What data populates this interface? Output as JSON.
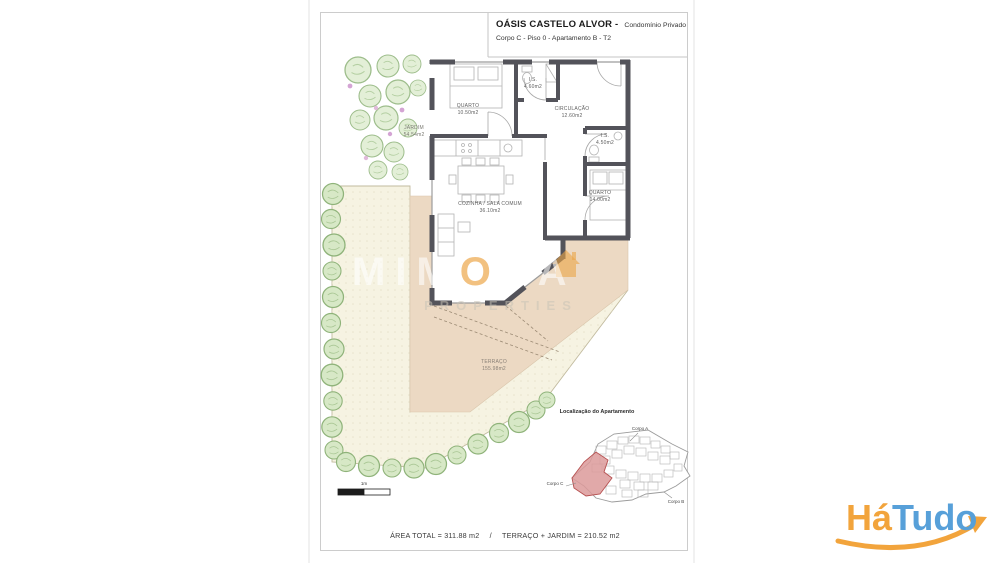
{
  "title_block": {
    "title": "OÁSIS CASTELO ALVOR -",
    "title_suffix": "Condomínio Privado",
    "subtitle": "Corpo C - Piso 0 - Apartamento B - T2"
  },
  "rooms": {
    "quarto1": {
      "name": "QUARTO",
      "area": "10.50m2"
    },
    "is1": {
      "name": "I.S.",
      "area": "4.60m2"
    },
    "circulacao": {
      "name": "CIRCULAÇÃO",
      "area": "12.60m2"
    },
    "is2": {
      "name": "I.S.",
      "area": "4.50m2"
    },
    "quarto2": {
      "name": "QUARTO",
      "area": "14.00m2"
    },
    "sala": {
      "name": "COZINHA / SALA COMUM",
      "area": "36.10m2"
    },
    "jardim": {
      "name": "JARDIM",
      "area": "54.54m2"
    },
    "terraco": {
      "name": "TERRAÇO",
      "area": "155.98m2"
    }
  },
  "footer": {
    "area_total": "ÁREA TOTAL = 311.88 m2",
    "separator": "/",
    "terraco_jardim": "TERRAÇO + JARDIM = 210.52 m2"
  },
  "minimap": {
    "title": "Localização do Apartamento",
    "labels": {
      "corpo_a": "Corpo A",
      "corpo_b": "Corpo B",
      "corpo_c": "Corpo C"
    },
    "highlight_color": "#dc9a9a"
  },
  "scalebar": {
    "label": "1m"
  },
  "watermark": {
    "left": "MIM",
    "o": "O",
    "right": "SA",
    "subline": "PROPERTIES"
  },
  "logo": {
    "ha": "Há",
    "tudo": "Tudo",
    "orange": "#F2A43C",
    "blue": "#57A0D9"
  },
  "colors": {
    "wall": "#53535a",
    "terrace": "#ecd9c3",
    "garden": "#f6f3e2",
    "tree_fill": "#d7e8c6",
    "tree_stroke": "#8fb37a",
    "minimap_highlight": "#dc9a9a"
  }
}
